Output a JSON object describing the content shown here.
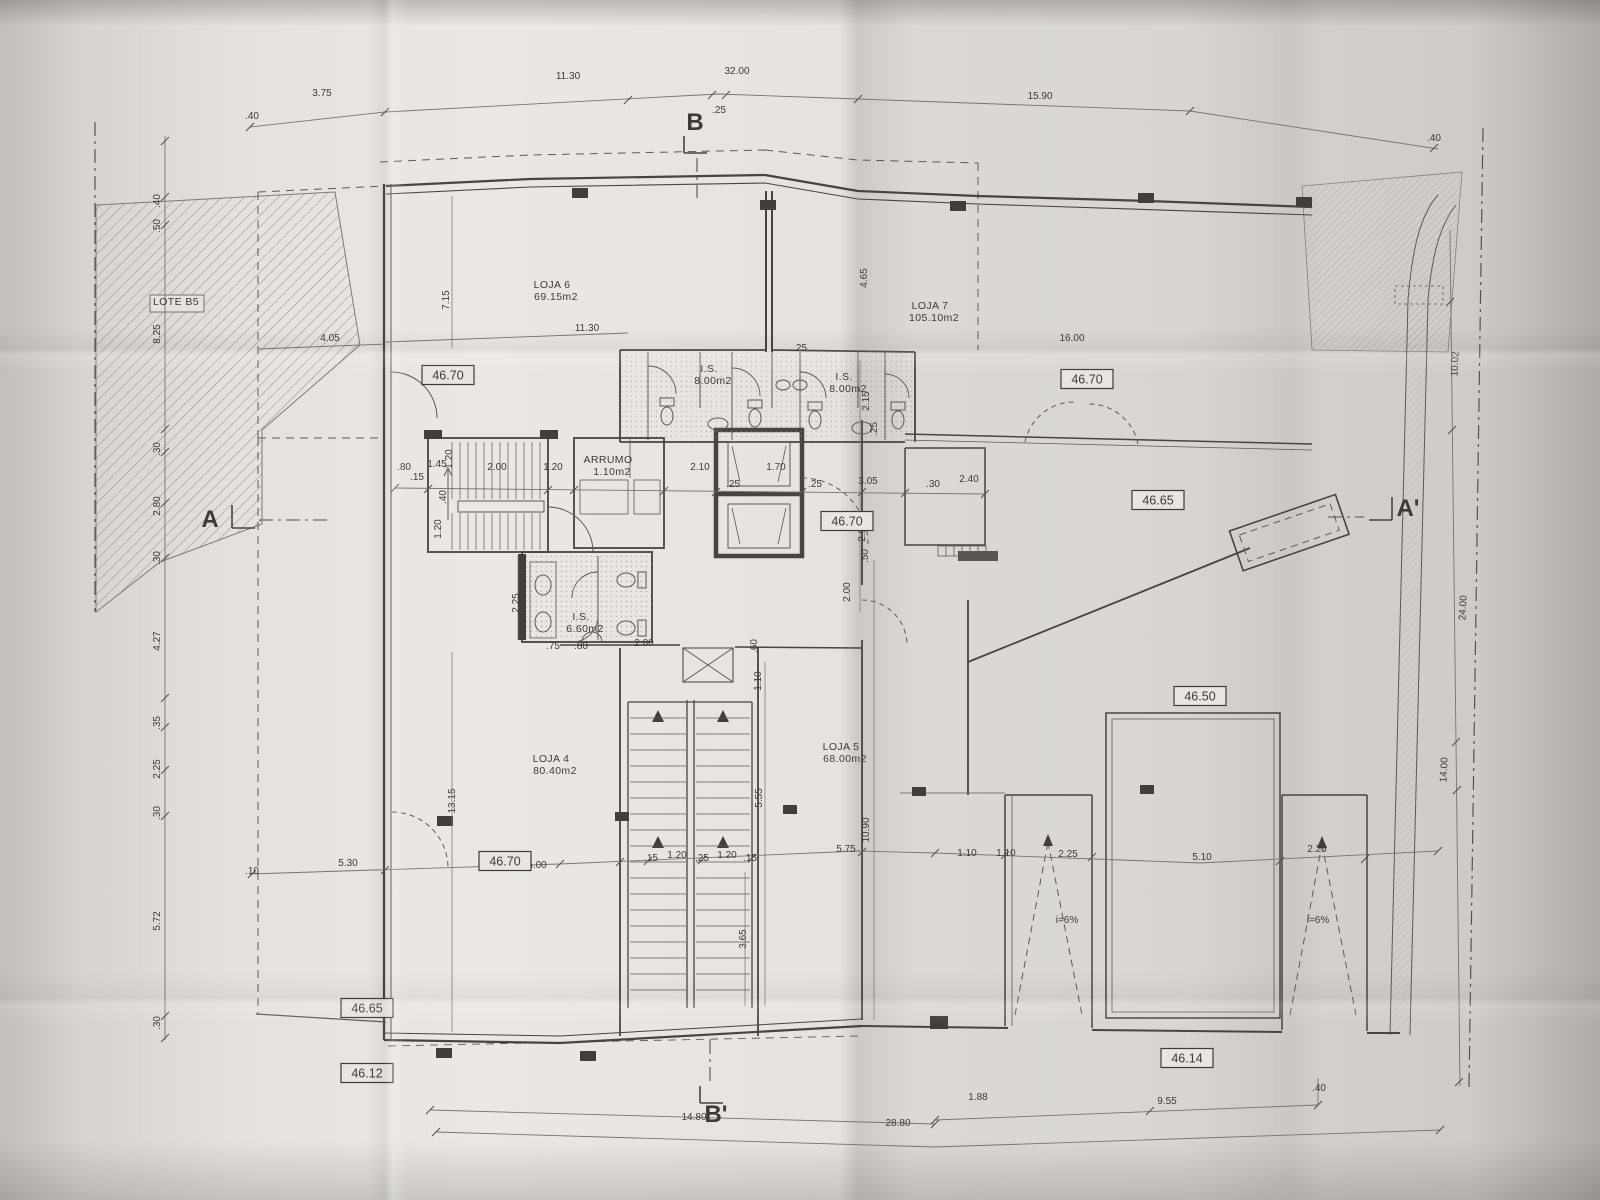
{
  "drawing": {
    "type": "architectural ground-floor plan (photographed folded print)",
    "ink_color": "#45423e",
    "paper_color": "#e4e1dc"
  },
  "labels": {
    "rooms": [
      {
        "name": "LOJA 6",
        "area": "69.15m2",
        "x": 552,
        "y": 288
      },
      {
        "name": "LOJA 7",
        "area": "105.10m2",
        "x": 930,
        "y": 309
      },
      {
        "name": "LOJA 4",
        "area": "80.40m2",
        "x": 551,
        "y": 762
      },
      {
        "name": "LOJA 5",
        "area": "68.00m2",
        "x": 841,
        "y": 750
      },
      {
        "name": "I.S.",
        "area": "8.00m2",
        "x": 709,
        "y": 372
      },
      {
        "name": "I.S.",
        "area": "8.00m2",
        "x": 844,
        "y": 380
      },
      {
        "name": "I.S.",
        "area": "6.60m2",
        "x": 581,
        "y": 620
      },
      {
        "name": "ARRUMO",
        "area": "1.10m2",
        "x": 608,
        "y": 463
      },
      {
        "name": "LOTE B5",
        "area": "",
        "x": 176,
        "y": 305
      }
    ],
    "elevations": [
      {
        "v": "46.70",
        "x": 448,
        "y": 375
      },
      {
        "v": "46.70",
        "x": 1087,
        "y": 379
      },
      {
        "v": "46.70",
        "x": 847,
        "y": 521
      },
      {
        "v": "46.65",
        "x": 1158,
        "y": 500
      },
      {
        "v": "46.50",
        "x": 1200,
        "y": 696
      },
      {
        "v": "46.70",
        "x": 505,
        "y": 861
      },
      {
        "v": "46.65",
        "x": 367,
        "y": 1008
      },
      {
        "v": "46.12",
        "x": 367,
        "y": 1073
      },
      {
        "v": "46.14",
        "x": 1187,
        "y": 1058
      }
    ],
    "sections": [
      {
        "t": "B",
        "x": 695,
        "y": 130
      },
      {
        "t": "B'",
        "x": 716,
        "y": 1122
      },
      {
        "t": "A",
        "x": 210,
        "y": 527
      },
      {
        "t": "A'",
        "x": 1408,
        "y": 516
      }
    ],
    "ramps": [
      {
        "t": "i=6%",
        "x": 1067,
        "y": 923
      },
      {
        "t": "i=6%",
        "x": 1318,
        "y": 923
      }
    ],
    "dims": [
      {
        "t": ".40",
        "x": 252,
        "y": 119
      },
      {
        "t": "3.75",
        "x": 322,
        "y": 96
      },
      {
        "t": "11.30",
        "x": 568,
        "y": 79
      },
      {
        "t": "32.00",
        "x": 737,
        "y": 74
      },
      {
        "t": ".25",
        "x": 719,
        "y": 113
      },
      {
        "t": "15.90",
        "x": 1040,
        "y": 99
      },
      {
        "t": ".40",
        "x": 1434,
        "y": 141
      },
      {
        "t": ".40",
        "x": 160,
        "y": 201,
        "r": -90
      },
      {
        "t": ".50",
        "x": 160,
        "y": 226,
        "r": -90
      },
      {
        "t": "8.25",
        "x": 160,
        "y": 334,
        "r": -90
      },
      {
        "t": ".30",
        "x": 160,
        "y": 449,
        "r": -90
      },
      {
        "t": "2.80",
        "x": 160,
        "y": 506,
        "r": -90
      },
      {
        "t": ".30",
        "x": 160,
        "y": 558,
        "r": -90
      },
      {
        "t": "4.27",
        "x": 160,
        "y": 641,
        "r": -90
      },
      {
        "t": ".35",
        "x": 160,
        "y": 723,
        "r": -90
      },
      {
        "t": "2.25",
        "x": 160,
        "y": 769,
        "r": -90
      },
      {
        "t": ".30",
        "x": 160,
        "y": 813,
        "r": -90
      },
      {
        "t": "5.72",
        "x": 160,
        "y": 921,
        "r": -90
      },
      {
        "t": ".30",
        "x": 160,
        "y": 1023,
        "r": -90
      },
      {
        "t": "10.02",
        "x": 1458,
        "y": 364,
        "r": -87
      },
      {
        "t": "24.00",
        "x": 1466,
        "y": 608,
        "r": -87
      },
      {
        "t": "14.00",
        "x": 1447,
        "y": 770,
        "r": -87
      },
      {
        "t": "4.05",
        "x": 330,
        "y": 341
      },
      {
        "t": "7.15",
        "x": 449,
        "y": 300,
        "r": -90
      },
      {
        "t": "11.30",
        "x": 587,
        "y": 331
      },
      {
        "t": "16.00",
        "x": 1072,
        "y": 341
      },
      {
        "t": "4.65",
        "x": 867,
        "y": 278,
        "r": -90
      },
      {
        "t": ".25",
        "x": 800,
        "y": 351
      },
      {
        "t": "2.15",
        "x": 869,
        "y": 401,
        "r": -90
      },
      {
        "t": ".25",
        "x": 877,
        "y": 429,
        "r": -90
      },
      {
        "t": ".80",
        "x": 404,
        "y": 470
      },
      {
        "t": "1.45",
        "x": 437,
        "y": 467
      },
      {
        "t": ".15",
        "x": 417,
        "y": 480
      },
      {
        "t": "1.20",
        "x": 452,
        "y": 459,
        "r": -90
      },
      {
        "t": ".40",
        "x": 446,
        "y": 497,
        "r": -90
      },
      {
        "t": "1.20",
        "x": 441,
        "y": 529,
        "r": -90
      },
      {
        "t": "2.00",
        "x": 497,
        "y": 470
      },
      {
        "t": "1.20",
        "x": 553,
        "y": 470
      },
      {
        "t": "2.10",
        "x": 700,
        "y": 470
      },
      {
        "t": ".25",
        "x": 733,
        "y": 487
      },
      {
        "t": "1.70",
        "x": 776,
        "y": 470
      },
      {
        "t": ".25",
        "x": 815,
        "y": 487
      },
      {
        "t": "3.05",
        "x": 868,
        "y": 484
      },
      {
        "t": ".30",
        "x": 933,
        "y": 487
      },
      {
        "t": "2.40",
        "x": 969,
        "y": 482
      },
      {
        "t": "2.95",
        "x": 865,
        "y": 532,
        "r": -90
      },
      {
        "t": ".50",
        "x": 868,
        "y": 556,
        "r": -90
      },
      {
        "t": "2.00",
        "x": 850,
        "y": 592,
        "r": -90
      },
      {
        "t": "2.25",
        "x": 519,
        "y": 603,
        "r": -90
      },
      {
        "t": ".75",
        "x": 553,
        "y": 649
      },
      {
        "t": ".80",
        "x": 581,
        "y": 649
      },
      {
        "t": "2.80",
        "x": 644,
        "y": 646
      },
      {
        "t": ".60",
        "x": 757,
        "y": 646,
        "r": -90
      },
      {
        "t": "1.10",
        "x": 761,
        "y": 681,
        "r": -90
      },
      {
        "t": "5.55",
        "x": 762,
        "y": 798,
        "r": -90
      },
      {
        "t": "10.90",
        "x": 869,
        "y": 830,
        "r": -90
      },
      {
        "t": "3.65",
        "x": 746,
        "y": 939,
        "r": -90
      },
      {
        "t": "13.15",
        "x": 455,
        "y": 801,
        "r": -90
      },
      {
        "t": "5.75",
        "x": 846,
        "y": 852
      },
      {
        "t": ".15",
        "x": 651,
        "y": 861
      },
      {
        "t": "1.20",
        "x": 677,
        "y": 858
      },
      {
        "t": ".25",
        "x": 702,
        "y": 861
      },
      {
        "t": "1.20",
        "x": 727,
        "y": 858
      },
      {
        "t": ".15",
        "x": 750,
        "y": 861
      },
      {
        "t": ".10",
        "x": 252,
        "y": 874
      },
      {
        "t": "5.30",
        "x": 348,
        "y": 866
      },
      {
        "t": "6.00",
        "x": 537,
        "y": 868
      },
      {
        "t": "1.10",
        "x": 967,
        "y": 856
      },
      {
        "t": "1.10",
        "x": 1006,
        "y": 856
      },
      {
        "t": "2.25",
        "x": 1068,
        "y": 857
      },
      {
        "t": "5.10",
        "x": 1202,
        "y": 860
      },
      {
        "t": "2.25",
        "x": 1317,
        "y": 852
      },
      {
        "t": "14.80",
        "x": 694,
        "y": 1120
      },
      {
        "t": "28.80",
        "x": 898,
        "y": 1126
      },
      {
        "t": "1.88",
        "x": 978,
        "y": 1100
      },
      {
        "t": "9.55",
        "x": 1167,
        "y": 1104
      },
      {
        "t": ".40",
        "x": 1319,
        "y": 1091
      }
    ]
  }
}
